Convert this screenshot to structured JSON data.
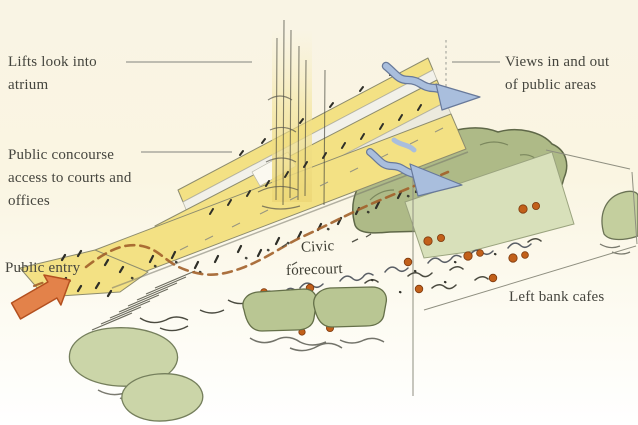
{
  "diagram": {
    "type": "architectural-concept-sketch",
    "labels": {
      "lifts_atrium": "Lifts look into atrium",
      "public_concourse": "Public concourse access to courts and offices",
      "public_entry": "Public entry",
      "views": "Views in and out of public areas",
      "civic_line1": "Civic",
      "civic_line2": "forecourt",
      "left_bank_cafes": "Left bank cafes"
    },
    "icons": {
      "public_entry_arrow": "block-arrow-up-right",
      "view_arrow_upper": "wavy-ribbon-arrow-right",
      "view_arrow_lower": "wavy-ribbon-arrow-down-right"
    },
    "colors": {
      "background_cream": "#faf5e2",
      "building_yellow": "#f3e184",
      "tree_green": "#aeba87",
      "terrace_pale_green": "#d8e0ba",
      "bush_green": "#cbd5a8",
      "hedge_green": "#b9c693",
      "view_arrow_blue": "#a9bedd",
      "entry_arrow_orange": "#e3824a",
      "cafe_dot_orange": "#c2601a",
      "path_dash_brown": "#a2602a",
      "label_text": "#45453e",
      "leader_line_gray": "#9b9b92"
    }
  }
}
